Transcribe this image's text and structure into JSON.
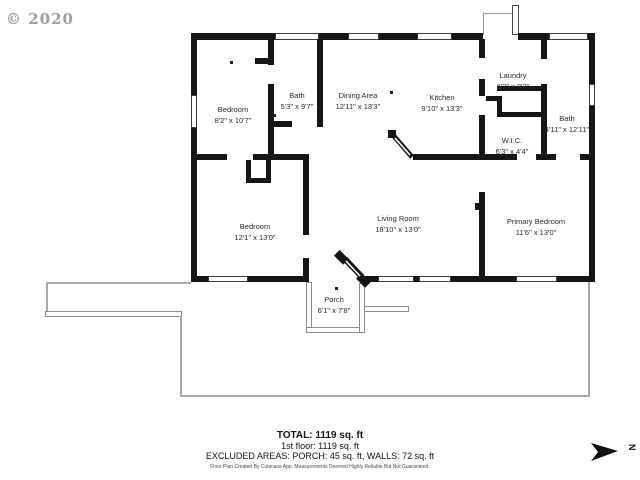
{
  "watermark": {
    "copyright": "© 2020"
  },
  "compass": {
    "label": "N"
  },
  "rooms": [
    {
      "id": "bedroom-1",
      "name": "Bedroom",
      "dims": "8'2\" x 10'7\""
    },
    {
      "id": "bath-1",
      "name": "Bath",
      "dims": "5'3\" x 9'7\""
    },
    {
      "id": "dining",
      "name": "Dining Area",
      "dims": "12'11\" x 13'3\""
    },
    {
      "id": "kitchen",
      "name": "Kitchen",
      "dims": "9'10\" x 13'3\""
    },
    {
      "id": "laundry",
      "name": "Laundry",
      "dims": "6'3\" x 8'3\""
    },
    {
      "id": "bath-2",
      "name": "Bath",
      "dims": "4'11\" x 12'11\""
    },
    {
      "id": "wic",
      "name": "W.I.C.",
      "dims": "6'3\" x 4'4\""
    },
    {
      "id": "bedroom-2",
      "name": "Bedroom",
      "dims": "12'1\" x 13'0\""
    },
    {
      "id": "living",
      "name": "Living Room",
      "dims": "18'10\" x 13'0\""
    },
    {
      "id": "primary",
      "name": "Primary Bedroom",
      "dims": "11'6\" x 13'0\""
    },
    {
      "id": "porch",
      "name": "Porch",
      "dims": "6'1\" x 7'8\""
    }
  ],
  "summary": {
    "total": "TOTAL: 1119 sq. ft",
    "first_floor": "1st floor: 1119 sq. ft",
    "excluded": "EXCLUDED AREAS: PORCH: 45 sq. ft, WALLS: 72 sq. ft",
    "disclaimer": "Floor Plan Created By Cubicasa App. Measurements Deemed Highly Reliable But Not Guaranteed."
  }
}
